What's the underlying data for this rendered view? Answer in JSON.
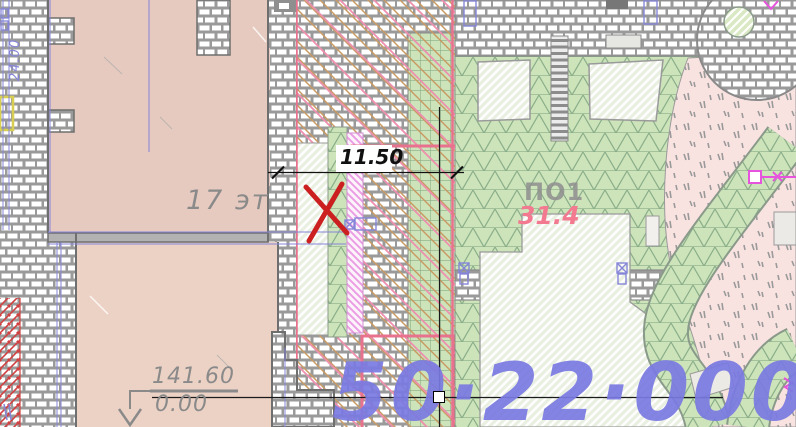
{
  "canvas": {
    "width": 796,
    "height": 427
  },
  "plan": {
    "vertical_dimension": "24.00",
    "floors_label": "17 эт",
    "width_dimension": "11.50",
    "area_label": "ПО1",
    "area_value": "31.4",
    "elevation_absolute": "141.60",
    "elevation_relative": "0.00",
    "cadastral_number": "50·22·00000"
  },
  "colors": {
    "building_fill": "#e6cabf",
    "building_fill_lower": "#ecd2c5",
    "wall_mortar": "#9a9a9a",
    "green_fill": "#cde4ba",
    "green_line": "#8aae8a",
    "hatch_light_fill": "#e9efe1",
    "stipple_fill": "#f9e3e1",
    "accent_pink": "#e8718e",
    "magenta": "#e653dc",
    "blue_line": "#8585d8",
    "blue_text": "#7a7ae2",
    "orange_line": "#c99b63",
    "red_mark": "#cc2020",
    "gray_text": "#8a8a8a",
    "dimension_text": "#101010",
    "yellow_accent": "#d8ce52"
  }
}
